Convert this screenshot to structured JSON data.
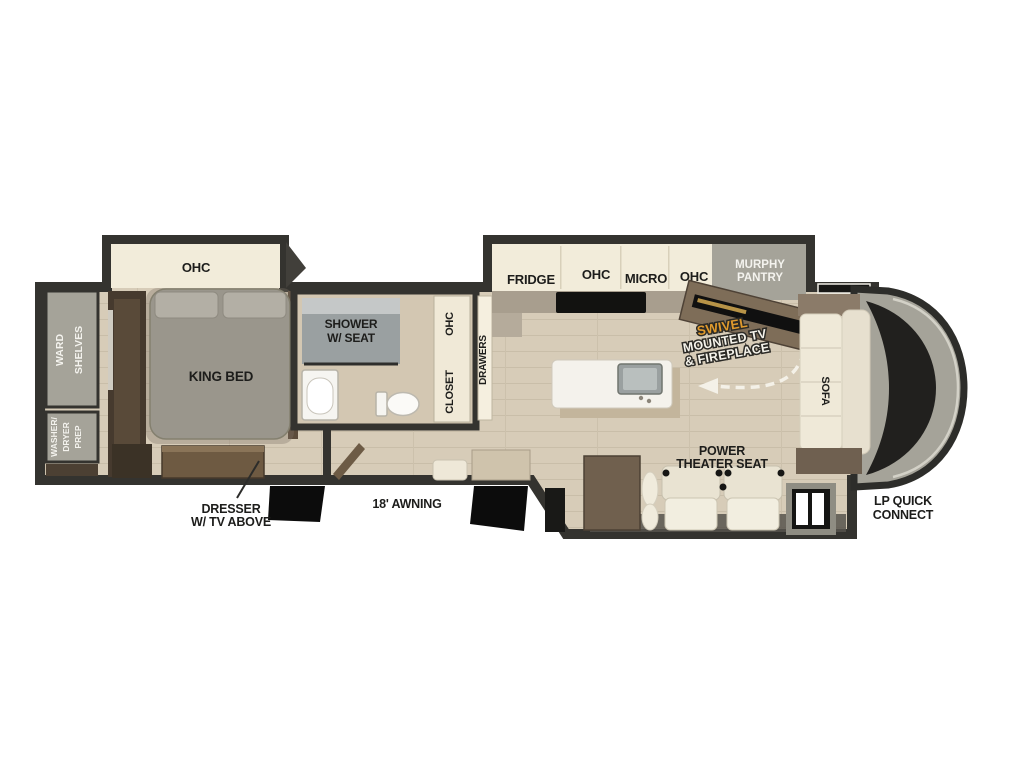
{
  "title": "Fifth Wheel RV Floor Plan",
  "colors": {
    "background": "#ffffff",
    "wall": "#34332f",
    "floor": "#d7ccb8",
    "cabinet_cream": "#f2ecda",
    "unit_gray": "#a5a399",
    "shower_gray": "#9aa0a1",
    "furniture_brown": "#6e5a42",
    "dark_wood": "#463a2e",
    "sofa_cream": "#efe9d8",
    "accent_gold": "#e09a2d",
    "label_black": "#1d1d1b",
    "label_white": "#f4f3ee",
    "step_black": "#0c0c0c"
  },
  "labels": {
    "bedroom_ohc": "OHC",
    "ward": "WARD",
    "shelves": "SHELVES",
    "washer": "WASHER/",
    "dryer": "DRYER",
    "prep": "PREP",
    "king_bed": "KING BED",
    "dresser_line1": "DRESSER",
    "dresser_line2": "W/ TV ABOVE",
    "shower_line1": "SHOWER",
    "shower_line2": "W/ SEAT",
    "closet_ohc": "OHC",
    "closet": "CLOSET",
    "drawers": "DRAWERS",
    "fridge": "FRIDGE",
    "kitchen_ohc_left": "OHC",
    "micro": "MICRO",
    "kitchen_ohc_right": "OHC",
    "murphy_line1": "MURPHY",
    "murphy_line2": "PANTRY",
    "swivel_line1": "SWIVEL",
    "swivel_line2": "MOUNTED TV",
    "swivel_line3": "& FIREPLACE",
    "sofa": "SOFA",
    "theater_line1": "POWER",
    "theater_line2": "THEATER SEAT",
    "awning": "18' AWNING",
    "lp_line1": "LP QUICK",
    "lp_line2": "CONNECT"
  }
}
